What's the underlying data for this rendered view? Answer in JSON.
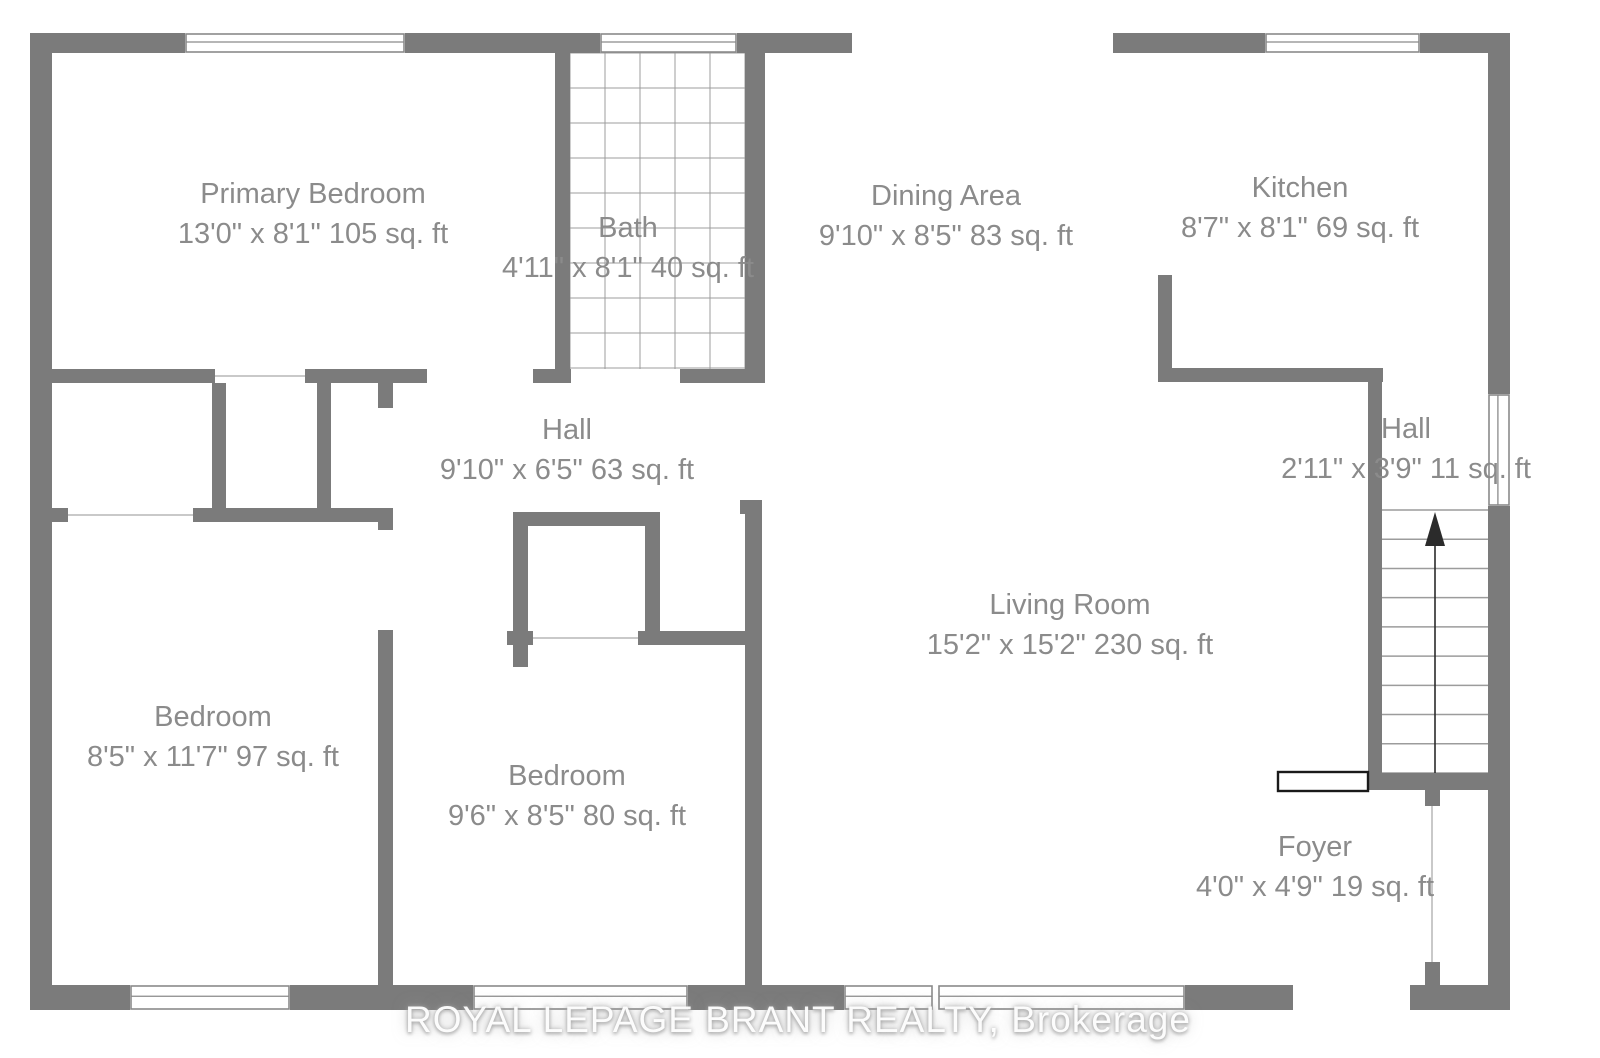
{
  "page": {
    "background": "#ffffff",
    "canvas": {
      "w": 1600,
      "h": 1058
    }
  },
  "colors": {
    "wall": "#7b7b7b",
    "label_text": "#8b8b8b",
    "tile_line": "#9c9c9c",
    "tread_line": "#9c9c9c",
    "open_line": "#c9c9c9",
    "window_frame": "#8a8a8a",
    "arrow": "#2b2b2b",
    "railing_border": "#1a1a1a"
  },
  "watermark": {
    "text": "ROYAL LEPAGE BRANT REALTY, Brokerage",
    "cx": 798,
    "cy": 1020
  },
  "rooms": [
    {
      "id": "primary-bedroom",
      "name": "Primary Bedroom",
      "dims": "13'0\" x 8'1\" 105 sq. ft",
      "cx": 313,
      "cy": 214
    },
    {
      "id": "bath",
      "name": "Bath",
      "dims": "4'11\" x 8'1\" 40 sq. ft",
      "cx": 628,
      "cy": 248
    },
    {
      "id": "dining-area",
      "name": "Dining Area",
      "dims": "9'10\" x 8'5\" 83 sq. ft",
      "cx": 946,
      "cy": 216
    },
    {
      "id": "kitchen",
      "name": "Kitchen",
      "dims": "8'7\" x 8'1\" 69 sq. ft",
      "cx": 1300,
      "cy": 208
    },
    {
      "id": "hall-center",
      "name": "Hall",
      "dims": "9'10\" x 6'5\" 63 sq. ft",
      "cx": 567,
      "cy": 450
    },
    {
      "id": "hall-upper",
      "name": "Hall",
      "dims": "2'11\" x 3'9\" 11 sq. ft",
      "cx": 1406,
      "cy": 449
    },
    {
      "id": "bedroom-left",
      "name": "Bedroom",
      "dims": "8'5\" x 11'7\" 97 sq. ft",
      "cx": 213,
      "cy": 737
    },
    {
      "id": "bedroom-middle",
      "name": "Bedroom",
      "dims": "9'6\" x 8'5\" 80 sq. ft",
      "cx": 567,
      "cy": 796
    },
    {
      "id": "living-room",
      "name": "Living Room",
      "dims": "15'2\" x 15'2\" 230 sq. ft",
      "cx": 1070,
      "cy": 625
    },
    {
      "id": "foyer",
      "name": "Foyer",
      "dims": "4'0\" x 4'9\" 19 sq. ft",
      "cx": 1315,
      "cy": 867
    }
  ],
  "geometry": {
    "walls": [
      [
        30,
        33,
        155,
        20
      ],
      [
        405,
        33,
        195,
        20
      ],
      [
        737,
        33,
        115,
        20
      ],
      [
        1113,
        33,
        152,
        20
      ],
      [
        1420,
        33,
        90,
        20
      ],
      [
        30,
        33,
        22,
        977
      ],
      [
        1488,
        33,
        22,
        361
      ],
      [
        1488,
        506,
        22,
        504
      ],
      [
        30,
        985,
        100,
        25
      ],
      [
        290,
        985,
        183,
        25
      ],
      [
        688,
        985,
        156,
        25
      ],
      [
        1185,
        985,
        108,
        25
      ],
      [
        1410,
        985,
        100,
        25
      ],
      [
        52,
        369,
        163,
        14
      ],
      [
        305,
        369,
        122,
        14
      ],
      [
        533,
        369,
        38,
        14
      ],
      [
        680,
        369,
        85,
        14
      ],
      [
        555,
        53,
        15,
        330
      ],
      [
        745,
        53,
        20,
        330
      ],
      [
        378,
        383,
        15,
        25
      ],
      [
        212,
        383,
        14,
        125
      ],
      [
        317,
        383,
        14,
        125
      ],
      [
        52,
        508,
        16,
        14
      ],
      [
        193,
        508,
        200,
        14
      ],
      [
        378,
        508,
        15,
        22
      ],
      [
        378,
        630,
        15,
        355
      ],
      [
        513,
        512,
        15,
        133
      ],
      [
        513,
        512,
        147,
        14
      ],
      [
        645,
        512,
        15,
        133
      ],
      [
        740,
        500,
        22,
        14
      ],
      [
        745,
        514,
        17,
        471
      ],
      [
        507,
        631,
        26,
        14
      ],
      [
        638,
        631,
        124,
        14
      ],
      [
        513,
        645,
        15,
        22
      ],
      [
        1158,
        275,
        14,
        93
      ],
      [
        1158,
        368,
        225,
        14
      ],
      [
        1368,
        368,
        14,
        405
      ],
      [
        1368,
        773,
        142,
        17
      ],
      [
        1425,
        790,
        15,
        16
      ],
      [
        1425,
        962,
        15,
        23
      ]
    ],
    "windows": [
      {
        "x": 185,
        "y": 33,
        "w": 220,
        "h": 20,
        "orient": "h"
      },
      {
        "x": 600,
        "y": 33,
        "w": 137,
        "h": 20,
        "orient": "h"
      },
      {
        "x": 1265,
        "y": 33,
        "w": 155,
        "h": 20,
        "orient": "h"
      },
      {
        "x": 1488,
        "y": 394,
        "w": 22,
        "h": 112,
        "orient": "v"
      },
      {
        "x": 130,
        "y": 985,
        "w": 160,
        "h": 25,
        "orient": "h"
      },
      {
        "x": 473,
        "y": 985,
        "w": 215,
        "h": 25,
        "orient": "h"
      },
      {
        "x": 844,
        "y": 985,
        "w": 89,
        "h": 25,
        "orient": "h"
      },
      {
        "x": 938,
        "y": 985,
        "w": 247,
        "h": 25,
        "orient": "h"
      }
    ],
    "open_lines": [
      [
        215,
        376,
        305,
        376
      ],
      [
        68,
        515,
        193,
        515
      ],
      [
        533,
        638,
        638,
        638
      ],
      [
        1432,
        806,
        1432,
        962
      ]
    ],
    "tile": {
      "x": 570,
      "y": 53,
      "w": 175,
      "h": 316,
      "cell": 35
    },
    "stairs": {
      "x": 1382,
      "y": 510,
      "w": 106,
      "h": 263,
      "treads": 9
    },
    "arrow": {
      "x": 1435,
      "y1": 773,
      "y2": 544,
      "head": [
        [
          1435,
          512
        ],
        [
          1425,
          546
        ],
        [
          1445,
          546
        ]
      ]
    },
    "railing": {
      "x": 1278,
      "y": 772,
      "w": 90,
      "h": 19
    }
  }
}
